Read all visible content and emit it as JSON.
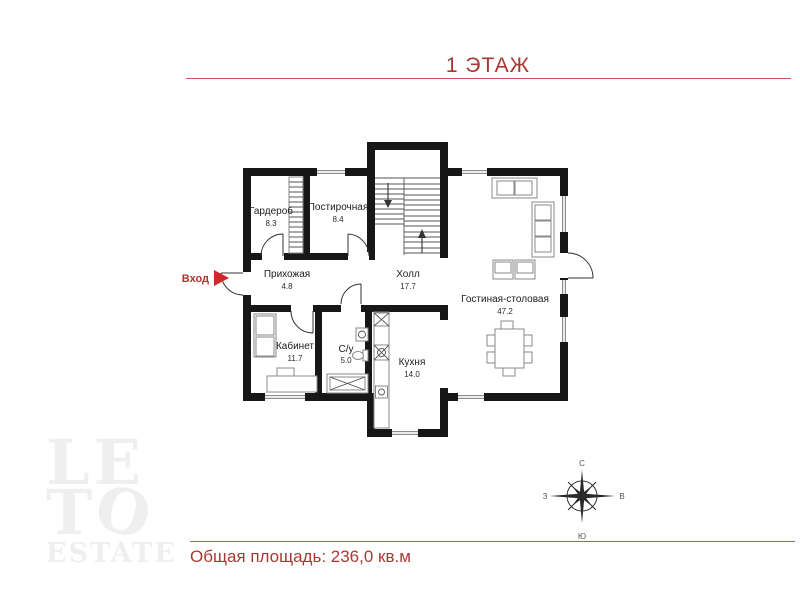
{
  "header": {
    "title": "1 ЭТАЖ"
  },
  "floorplan": {
    "entrance_label": "Вход",
    "rooms": [
      {
        "name": "Гардероб",
        "area": "8.3"
      },
      {
        "name": "Постирочная",
        "area": "8.4"
      },
      {
        "name": "Прихожая",
        "area": "4.8"
      },
      {
        "name": "Холл",
        "area": "17.7"
      },
      {
        "name": "Гостиная-столовая",
        "area": "47.2"
      },
      {
        "name": "Кабинет",
        "area": "11.7"
      },
      {
        "name": "С/у",
        "area": "5.0"
      },
      {
        "name": "Кухня",
        "area": "14.0"
      }
    ]
  },
  "compass": {
    "north": "С",
    "south": "Ю",
    "west": "З",
    "east": "В"
  },
  "footer": {
    "total_area": "Общая площадь: 236,0 кв.м"
  },
  "logo": {
    "line1": "LE",
    "line2_t": "T",
    "line2_o": "O",
    "line3": "ESTATE"
  },
  "colors": {
    "accent": "#a93832",
    "rule": "#c65a52",
    "wall": "#171717",
    "entrance_arrow": "#cf2828"
  }
}
